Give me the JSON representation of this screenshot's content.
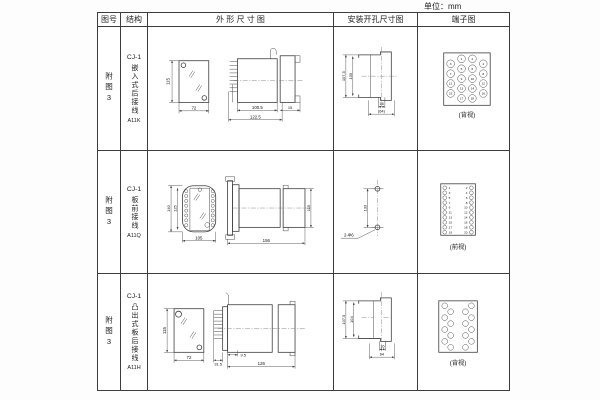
{
  "unit_label": "单位：mm",
  "header": {
    "fig": "图号",
    "struct": "结构",
    "outline": "外 形 尺 寸 图",
    "mount": "安装开孔尺寸图",
    "terminal": "端子图"
  },
  "rows": [
    {
      "fig": "附图3",
      "model": "CJ-1",
      "struct": "嵌入式后接线",
      "code": "A11K",
      "outline": {
        "h": "115",
        "w": "72",
        "d1": "100.5",
        "d2": "122.5",
        "d3": "15"
      },
      "mount": {
        "h1": "107.5",
        "h2": "105",
        "w1": "16",
        "w2": "(64)"
      },
      "terminal": {
        "view": "(背视)",
        "numbers": [
          "1",
          "2",
          "3",
          "4",
          "5",
          "6",
          "7",
          "8",
          "9",
          "10",
          "11",
          "12",
          "13",
          "14",
          "15",
          "16",
          "17",
          "18"
        ]
      }
    },
    {
      "fig": "附图3",
      "model": "CJ-1",
      "struct": "板前接线",
      "code": "A11Q",
      "outline": {
        "h": "140",
        "h2": "125",
        "w": "105",
        "d1": "156",
        "d2": "115"
      },
      "mount": {
        "d": "133",
        "hole": "2-Φ6"
      },
      "terminal": {
        "view": "(前视)",
        "left": [
          "1",
          "3",
          "5",
          "7",
          "9",
          "11",
          "13",
          "15",
          "17",
          "19"
        ],
        "right": [
          "2",
          "4",
          "6",
          "8",
          "10",
          "12",
          "14",
          "16",
          "18",
          "20"
        ]
      }
    },
    {
      "fig": "附图3",
      "model": "CJ-1",
      "struct": "凸出式板后接线",
      "code": "A11H",
      "outline": {
        "h": "115",
        "w": "72",
        "d1": "31.5",
        "d2": "9.5",
        "d3": "126"
      },
      "mount": {
        "h1": "107.5",
        "h2": "104",
        "w1": "16",
        "w2": "64"
      },
      "terminal": {
        "view": "(背视)"
      }
    }
  ]
}
